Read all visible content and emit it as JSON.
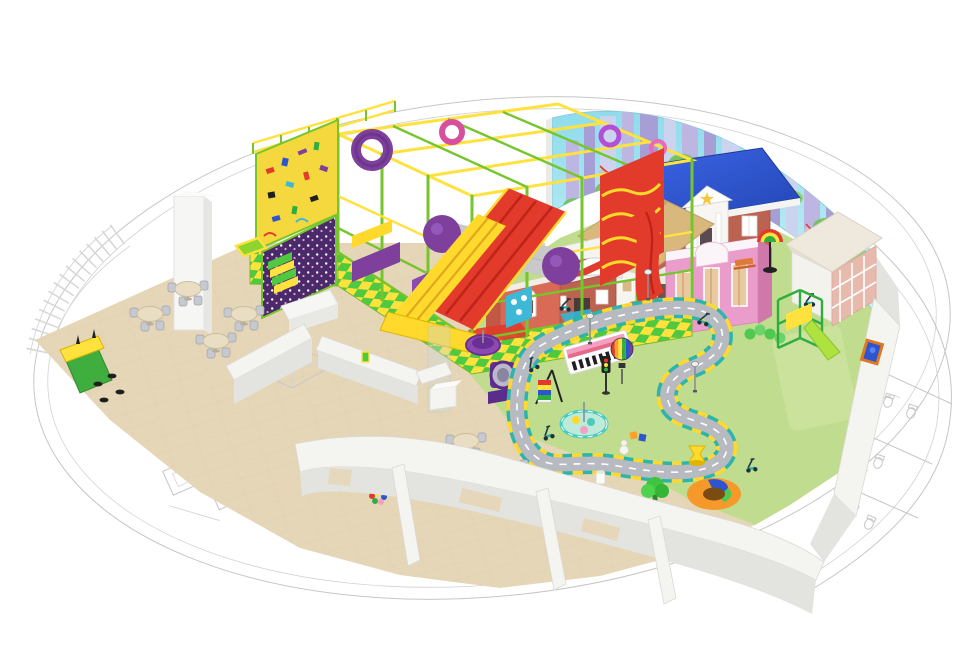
{
  "scene": {
    "type": "3d-floorplan-render",
    "subject": "indoor-playground-design"
  },
  "zones": [
    {
      "name": "cafe-seating-area"
    },
    {
      "name": "reception-snack-counter"
    },
    {
      "name": "soft-play-structure"
    },
    {
      "name": "role-play-town"
    },
    {
      "name": "toddler-soft-play-area"
    },
    {
      "name": "service-rooms-floor-plan"
    }
  ],
  "counts": {
    "cafe_tables": 8,
    "counter_stools": 4
  },
  "palette": {
    "background": "#ffffff",
    "cadLine": "#c6c6c6",
    "floorBeige": "#e6d6b8",
    "floorBeigeLine": "#d8c5a3",
    "floorGreen": "#c0dc8e",
    "floorGreenLight": "#d5e8ab",
    "road": "#b7bac0",
    "curbTeal": "#2cb5ab",
    "curbYellow": "#ffd92b",
    "muralSkyTop": "#8fdcec",
    "muralSkyBottom": "#cdf1f7",
    "muralBuildingA": "#beb6e2",
    "muralBuildingB": "#a79ed6",
    "muralBuildingC": "#ccd3ee",
    "muralBush": "#74c462",
    "frameYellow": "#ffe23e",
    "frameGreen": "#76c52d",
    "slideRed": "#e23a2b",
    "slideRedDark": "#bf2418",
    "slideYellow": "#ffd92b",
    "purple": "#7e3f9d",
    "purpleDark": "#4a2a6a",
    "climbYellow": "#f5d73e",
    "panelBlue": "#3fb8d8",
    "tubeGray": "#c9c9c9",
    "roofBlue": "#2d55cf",
    "brick": "#bc6250",
    "playhouseRed": "#d96a55",
    "housePink": "#ea9ccb",
    "roofTan": "#d8b87d",
    "awningRed": "#e03c2e",
    "wallWhite": "#f4f4f1",
    "wallFace": "#e3e3df",
    "tableTop": "#e9ddc3",
    "chairGray": "#c6c9cf",
    "counterGreen": "#3fae3f",
    "counterYellow": "#ffe23e",
    "treeGreen": "#3ec43e",
    "donutOrange": "#f59a2a",
    "carouselTeal": "#49cbbd"
  }
}
